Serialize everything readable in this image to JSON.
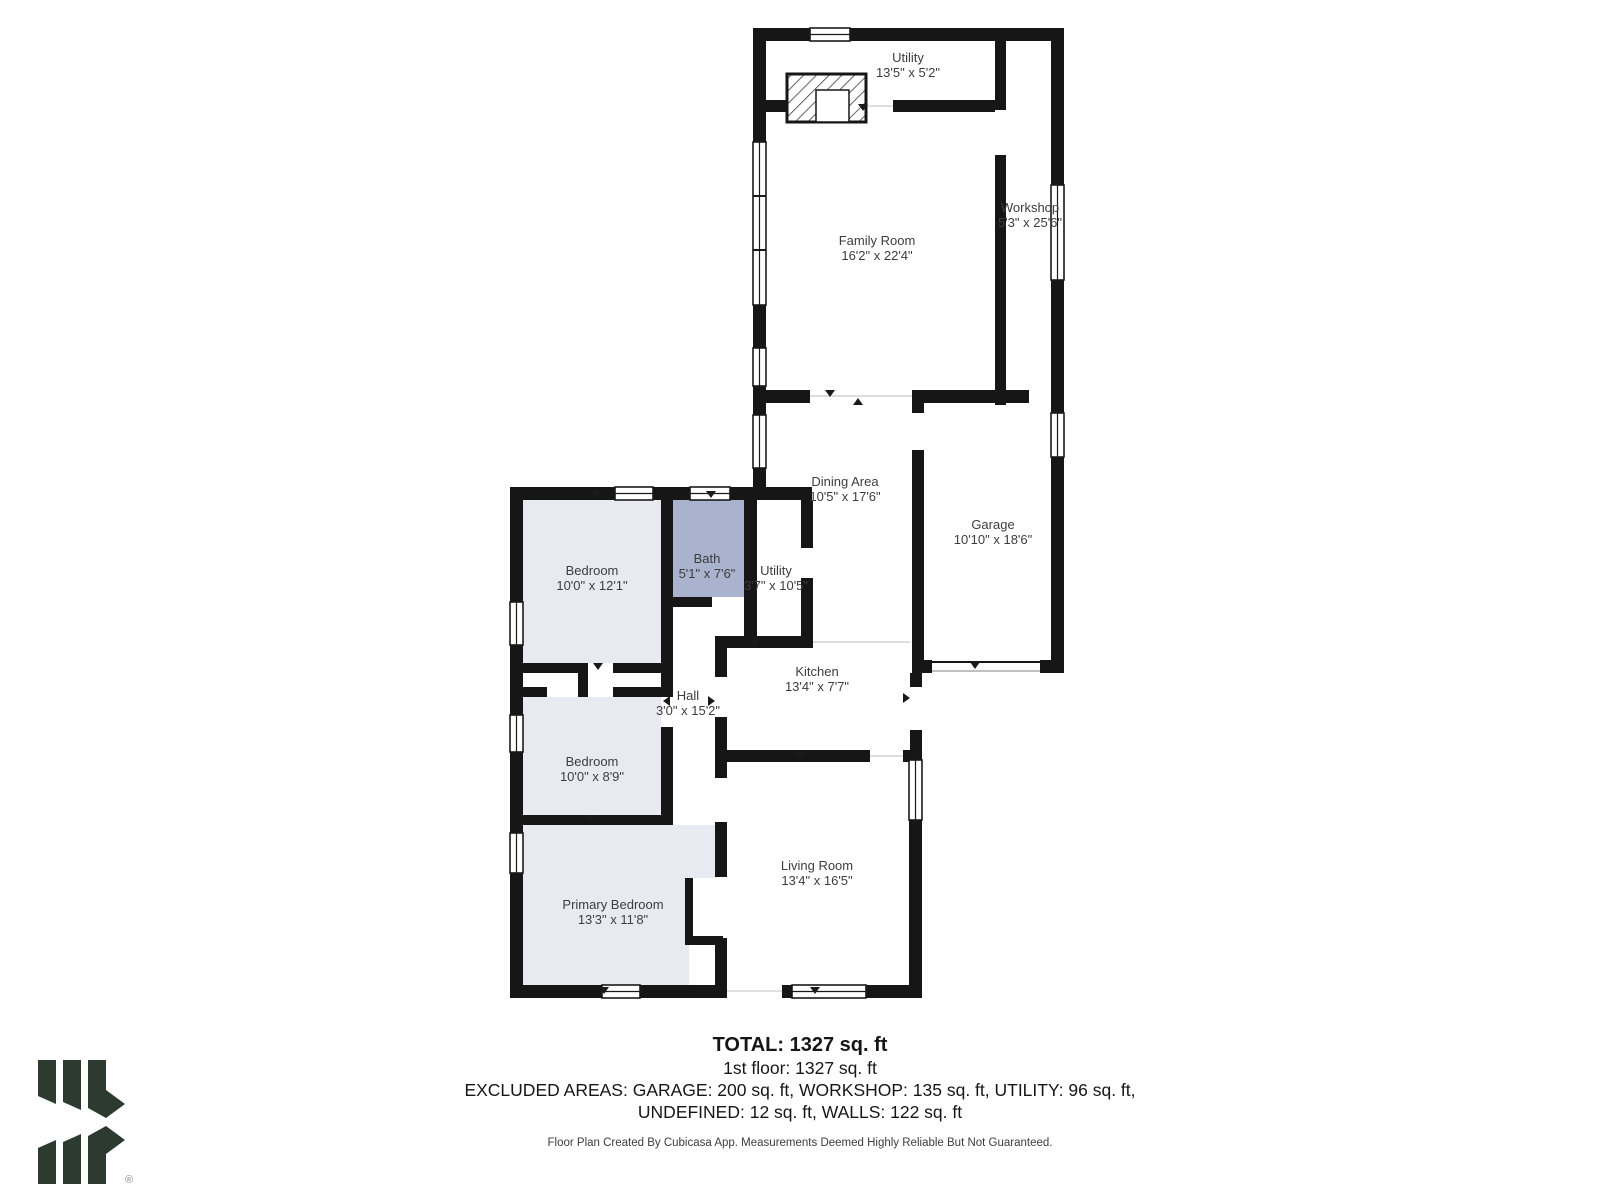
{
  "plan": {
    "rooms": [
      {
        "name": "Utility",
        "dims": "13'5\" x 5'2\""
      },
      {
        "name": "Family Room",
        "dims": "16'2\" x 22'4\""
      },
      {
        "name": "Workshop",
        "dims": "5'3\" x 25'6\""
      },
      {
        "name": "Dining Area",
        "dims": "10'5\" x 17'6\""
      },
      {
        "name": "Garage",
        "dims": "10'10\" x 18'6\""
      },
      {
        "name": "Bedroom",
        "dims": "10'0\" x 12'1\""
      },
      {
        "name": "Bath",
        "dims": "5'1\" x 7'6\""
      },
      {
        "name": "Utility",
        "dims": "3'7\" x 10'5\""
      },
      {
        "name": "Kitchen",
        "dims": "13'4\" x 7'7\""
      },
      {
        "name": "Hall",
        "dims": "3'0\" x 15'2\""
      },
      {
        "name": "Bedroom",
        "dims": "10'0\" x 8'9\""
      },
      {
        "name": "Primary Bedroom",
        "dims": "13'3\" x 11'8\""
      },
      {
        "name": "Living Room",
        "dims": "13'4\" x 16'5\""
      }
    ]
  },
  "summary": {
    "total": "TOTAL: 1327 sq. ft",
    "first_floor": "1st floor: 1327 sq. ft",
    "excluded_line1": "EXCLUDED AREAS: GARAGE: 200 sq. ft, WORKSHOP: 135 sq. ft, UTILITY: 96 sq. ft,",
    "excluded_line2": "UNDEFINED: 12 sq. ft, WALLS: 122 sq. ft",
    "disclaimer": "Floor Plan Created By Cubicasa App. Measurements Deemed Highly Reliable But Not Guaranteed."
  },
  "logo": {
    "registered_mark": "®"
  },
  "colors": {
    "wall": "#161616",
    "room_fill": "#e8eaf1",
    "bath_fill": "#a9b3cd",
    "logo_green": "#2c3a30"
  }
}
